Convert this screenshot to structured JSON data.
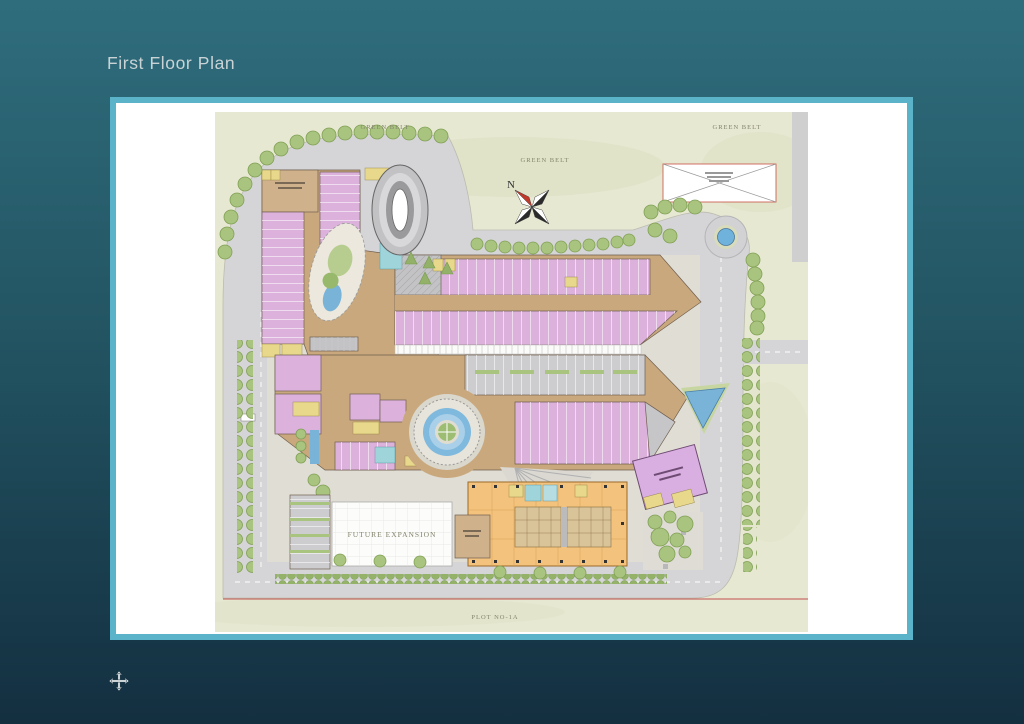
{
  "page": {
    "title": "First Floor Plan"
  },
  "plan": {
    "labels": {
      "green_belt_top": "GREEN BELT",
      "green_belt_right": "GREEN BELT",
      "green_belt_inner": "GREEN BELT",
      "compass_north": "N",
      "future_expansion": "FUTURE EXPANSION",
      "plot_number": "PLOT NO-1A"
    },
    "colors": {
      "background_top": "#2f6d7d",
      "background_bottom": "#132f40",
      "card_border": "#5ab3c8",
      "card_background": "#ffffff",
      "greenbelt": "#e7e8d2",
      "road": "#d5d5d7",
      "paver": "#e0ddd4",
      "retail_pink": "#dcb2dc",
      "corridor_tan": "#c9a87d",
      "office_orange": "#f3c27d",
      "water_blue": "#79b4d8",
      "tree_green": "#a9c47f",
      "service_yellow": "#e8d88c",
      "lift_cyan": "#9fd4da",
      "boundary_red": "#c0504d"
    },
    "icons": {
      "cursor": "move-icon",
      "compass": "north-arrow-icon"
    }
  }
}
